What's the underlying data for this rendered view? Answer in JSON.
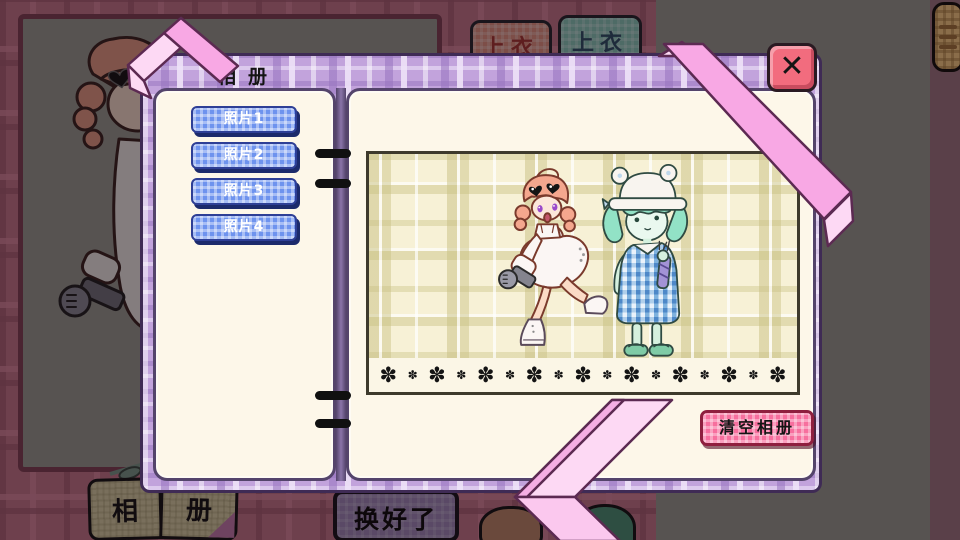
{
  "album_dialog": {
    "title": "相册",
    "photo_buttons": [
      "照片1",
      "照片2",
      "照片3",
      "照片4"
    ],
    "clear_album_button": "清空相册",
    "close_glyph": "✕",
    "ornament_glyph": "✽",
    "photo_ornament_count": 17
  },
  "background_ui": {
    "clothing_tabs": [
      "上衣",
      "上衣"
    ],
    "album_book": {
      "left_page": "相",
      "right_page": "册"
    },
    "done_button": "换好了"
  },
  "colors": {
    "cover_plaid": "#C2A3DC",
    "page_cream": "#FDF7E9",
    "photo_button_blue": "#6E93EE",
    "clear_button_pink": "#F76F9E",
    "close_button_red": "#F26C7E",
    "ribbon_pink": "#F8A8E4",
    "ribbon_light": "#FDD9F4",
    "photo_plaid": "#F7F1D6"
  }
}
